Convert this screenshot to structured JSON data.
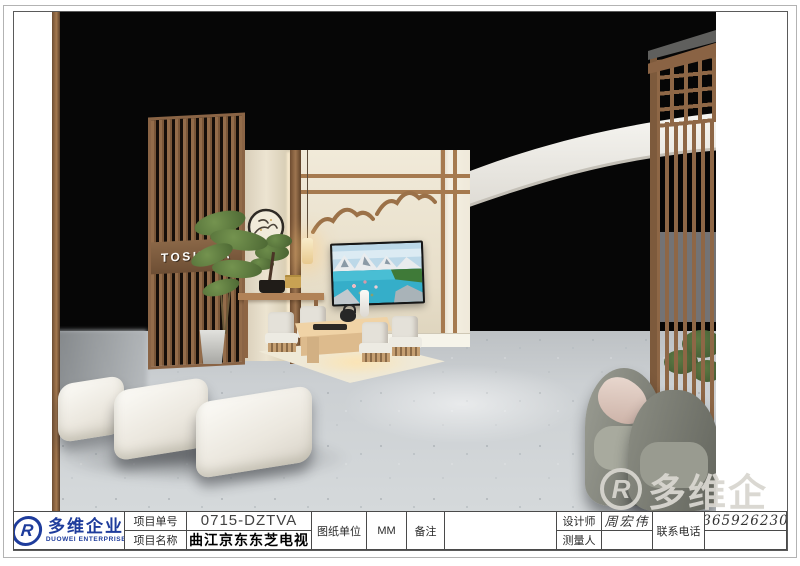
{
  "company": {
    "logo_name": "多维企业",
    "logo_name_en": "DUOWEI ENTERPRISE"
  },
  "title_block": {
    "project_no_label": "项目单号",
    "project_no_value": "0715-DZTVA",
    "project_name_label": "项目名称",
    "project_name_value": "曲江京东东芝电视",
    "unit_label": "图纸单位",
    "unit_value": "MM",
    "remark_label": "备注",
    "remark_value": "",
    "designer_label": "设计师",
    "designer_value": "周宏伟",
    "surveyor_label": "测量人",
    "surveyor_value": "",
    "phone_label": "联系电话",
    "phone_value": "13659262305"
  },
  "watermark": {
    "glyph": "R",
    "text": "多维企"
  },
  "scene": {
    "toshiba_sign": "TOSHIBA"
  },
  "colors": {
    "brand_blue": "#1e3c9c",
    "wood_brown": "#936c4a",
    "wall_beige": "#ece4d2",
    "floor_gray": "#cdd1d4",
    "render_background": "#060606"
  }
}
